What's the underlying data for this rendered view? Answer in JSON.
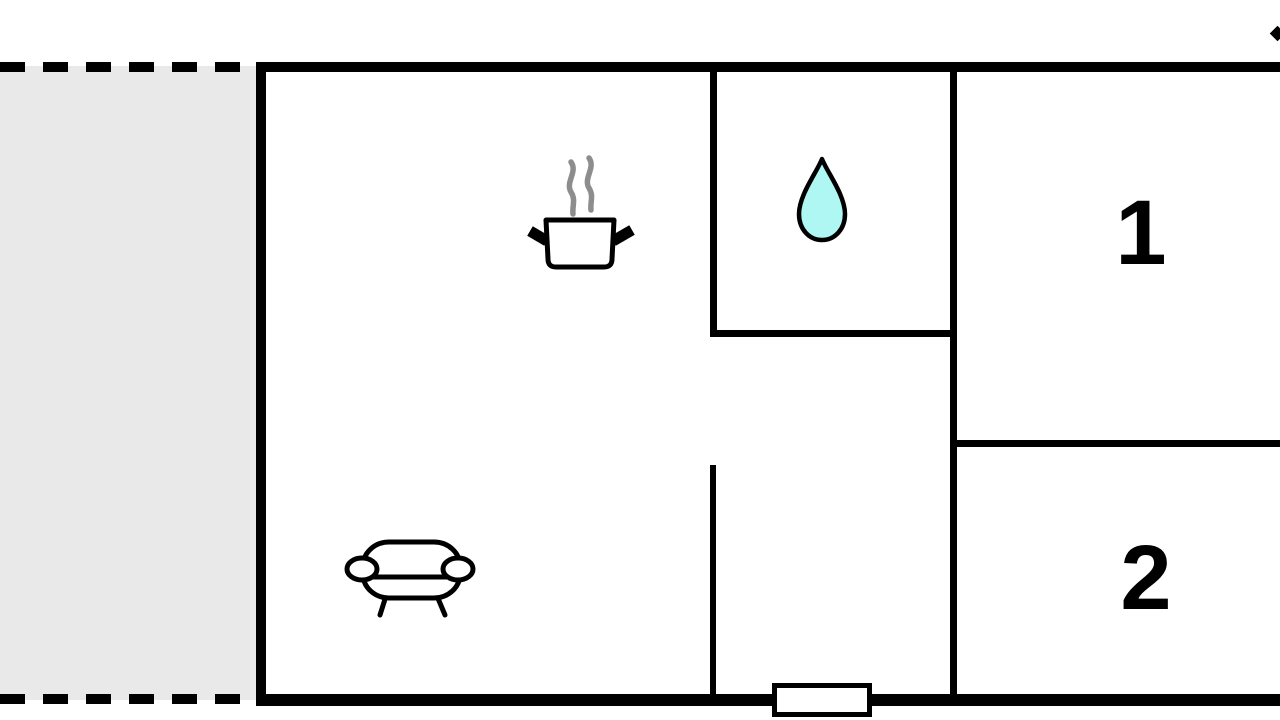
{
  "floorplan": {
    "title": "apartment floor plan",
    "rooms": [
      {
        "label": "1",
        "type": "bedroom"
      },
      {
        "label": "2",
        "type": "bedroom"
      }
    ],
    "areas": {
      "terrace": "dashed-outline gray terrace strip on left",
      "kitchen_living": "large open room with steam-pot and sofa icons",
      "bathroom": "small top-center room with water-drop icon",
      "entrance": "door opening centered in bottom wall"
    },
    "icons": [
      {
        "name": "steam-pot-icon",
        "meaning": "kitchen / cooking area"
      },
      {
        "name": "water-drop-icon",
        "meaning": "bathroom / water"
      },
      {
        "name": "sofa-icon",
        "meaning": "living area"
      },
      {
        "name": "edge-mark-icon",
        "meaning": "clipped marker at top-right edge"
      }
    ],
    "colors": {
      "wall": "#000000",
      "background": "#ffffff",
      "terrace_fill": "#e9e9e9",
      "water_drop_fill": "#aef7f2",
      "steam": "#8d8d8d"
    }
  }
}
